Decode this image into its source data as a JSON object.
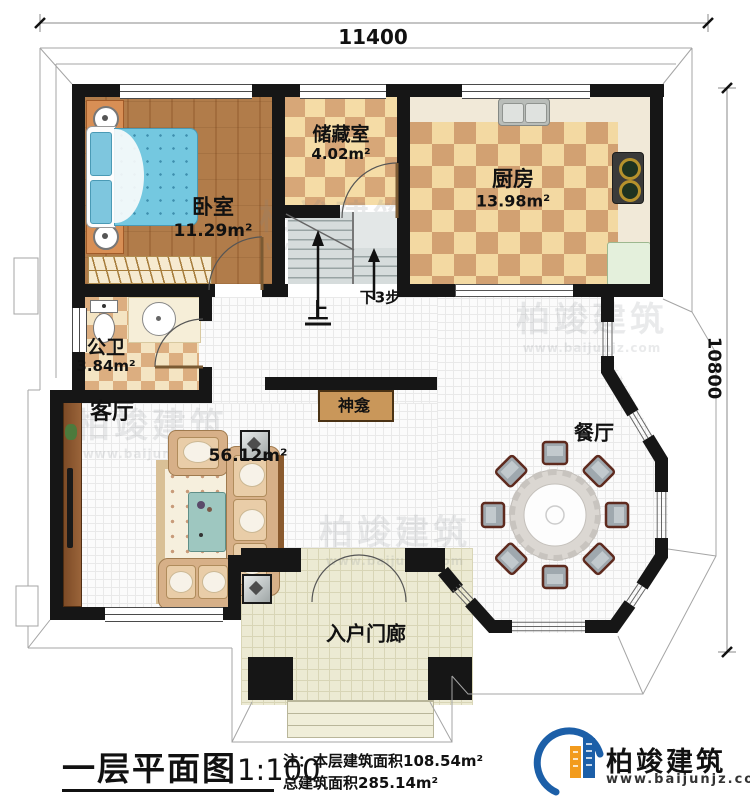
{
  "dimensions": {
    "width_top": "11400",
    "height_right": "10800"
  },
  "rooms": {
    "bedroom": {
      "label": "卧室",
      "area": "11.29m²"
    },
    "storage": {
      "label": "储藏室",
      "area": "4.02m²"
    },
    "kitchen": {
      "label": "厨房",
      "area": "13.98m²"
    },
    "bathroom": {
      "label": "公卫",
      "area": "3.84m²"
    },
    "living": {
      "label": "客厅",
      "area": "56.12m²"
    },
    "dining": {
      "label": "餐厅"
    },
    "shrine": {
      "label": "神龛"
    },
    "porch": {
      "label": "入户门廊"
    }
  },
  "stairs": {
    "up_label": "上",
    "down_label": "下3步"
  },
  "title_block": {
    "title": "一层平面图",
    "scale": "1:100",
    "note1": "注：本层建筑面积108.54m²",
    "note2": "总建筑面积285.14m²"
  },
  "brand": {
    "name": "柏竣建筑",
    "website": "www.baijunjz.com"
  },
  "watermark": {
    "text": "柏竣建筑",
    "website": "www.baijunjz.com"
  },
  "colors": {
    "wall": "#161616",
    "wood_floor": "#ad7542",
    "tile_light": "#f5dca6",
    "tile_dark": "#d7a778",
    "mattress_blue": "#74c8e0",
    "brand_blue": "#1c5fa8",
    "brand_orange": "#f29b1d"
  }
}
